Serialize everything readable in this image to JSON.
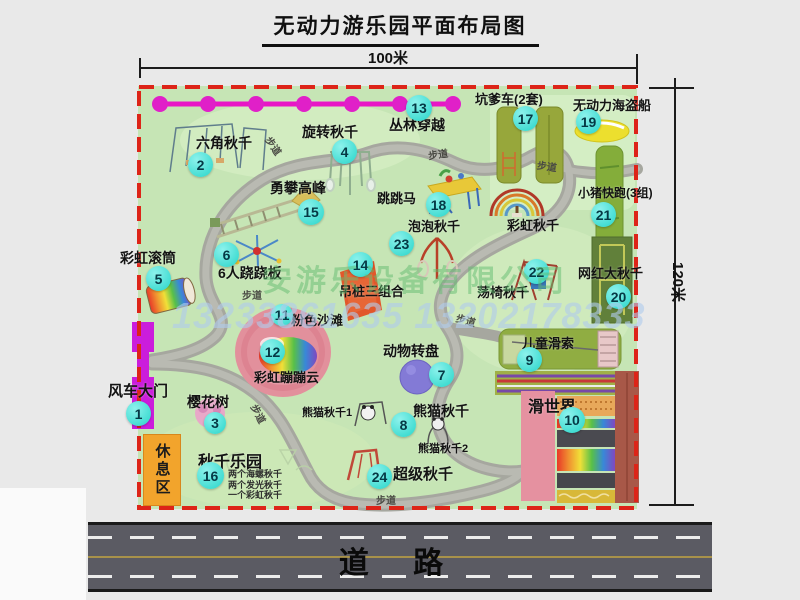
{
  "title": "无动力游乐园平面布局图",
  "dims": {
    "top": "100米",
    "right": "120米"
  },
  "road": {
    "label": "道 路"
  },
  "watermark": {
    "company": "安游乐设备有限公司",
    "phone": "13233861635 13202178333"
  },
  "rest_area": "休息区",
  "path_label": "步道",
  "pois": [
    {
      "num": "1",
      "label": "风车大门"
    },
    {
      "num": "2",
      "label": "六角秋千"
    },
    {
      "num": "3",
      "label": "樱花树"
    },
    {
      "num": "4",
      "label": "旋转秋千"
    },
    {
      "num": "5",
      "label": "彩虹滚筒"
    },
    {
      "num": "6",
      "label": "6人跷跷板"
    },
    {
      "num": "7",
      "label": "动物转盘"
    },
    {
      "num": "8",
      "label": "熊猫秋千"
    },
    {
      "num": "9",
      "label": "儿童滑索"
    },
    {
      "num": "10",
      "label": "滑世界"
    },
    {
      "num": "11",
      "label": "粉色沙滩"
    },
    {
      "num": "12",
      "label": "彩虹蹦蹦云"
    },
    {
      "num": "13",
      "label": "丛林穿越"
    },
    {
      "num": "14",
      "label": "吊桩三组合"
    },
    {
      "num": "15",
      "label": "勇攀高峰"
    },
    {
      "num": "16",
      "label": "秋千乐园"
    },
    {
      "num": "17",
      "label": "坑爹车(2套)"
    },
    {
      "num": "18",
      "label": "跳跳马"
    },
    {
      "num": "19",
      "label": "无动力海盗船"
    },
    {
      "num": "20",
      "label": "网红大秋千"
    },
    {
      "num": "21",
      "label": "小猪快跑(3组)"
    },
    {
      "num": "22",
      "label": "荡椅秋千"
    },
    {
      "num": "23",
      "label": "泡泡秋千"
    },
    {
      "num": "24",
      "label": "超级秋千"
    }
  ],
  "extra_labels": {
    "rainbow_swing": "彩虹秋千",
    "panda_swing_1": "熊猫秋千1",
    "panda_swing_2": "熊猫秋千2",
    "swing_park_items": {
      "0": "两个海螺秋千",
      "1": "两个发光秋千",
      "2": "一个彩虹秋千"
    }
  },
  "colors": {
    "park_green": "#c6e5b5",
    "border_red": "#dd2418",
    "badge_cyan": "#35e0d6",
    "gate_magenta": "#cb1ddb",
    "road_gray": "#5b5b63"
  }
}
